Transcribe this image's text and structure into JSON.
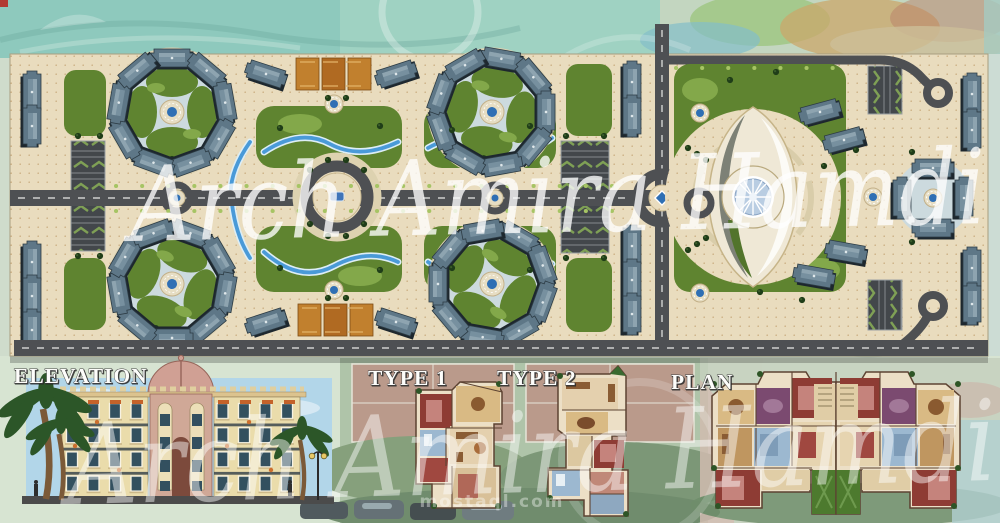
{
  "watermarks": {
    "artist_main": "Arch Amira Hamdi",
    "artist_bottom": "Arch Amira Hamdi",
    "site": "mostaql.com"
  },
  "section_labels": {
    "elevation": "ELEVATION",
    "type1": "TYPE 1",
    "type2": "TYPE 2",
    "plan": "PLAN"
  },
  "palette": {
    "paving": "#e9dcbe",
    "road": "#4e5053",
    "lawn": "#5f8430",
    "lawn_light": "#83a84a",
    "water": "#4a9ad8",
    "plaza": "#ccdade",
    "building": "#5e7787",
    "court_orange": "#c1802e",
    "fountain": "#2f6fb4",
    "landmark_cream": "#efe8d6",
    "dome_blue": "#b9cde2",
    "sky": "#b2d6e9",
    "facade": "#eadcab",
    "tower_pink": "#d0a897",
    "room_cream": "#ecdfc6",
    "room_maroon": "#8e3c34",
    "room_purple": "#7b4a70",
    "room_blue": "#9cb8d0",
    "courtyard_green": "#4d7a2e"
  }
}
